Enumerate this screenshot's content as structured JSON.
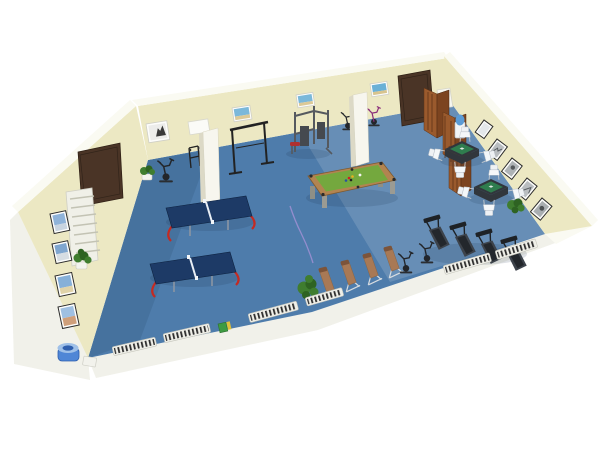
{
  "scene": {
    "type": "3d-room-render",
    "room": "recreation-and-fitness-room",
    "objects": [
      {
        "name": "ping-pong-table",
        "count": 2,
        "color": "#1d3a66"
      },
      {
        "name": "pool-table",
        "count": 1,
        "color": "#74a83e"
      },
      {
        "name": "mahjong-table",
        "count": 2,
        "color": "#2f7d4e"
      },
      {
        "name": "chair",
        "count": 8,
        "color": "#eef1f4"
      },
      {
        "name": "treadmill",
        "count": 4,
        "color": "#3d434b"
      },
      {
        "name": "incline-bench",
        "count": 4,
        "color": "#a87955"
      },
      {
        "name": "exercise-bike",
        "count": 5,
        "color": "#23262a"
      },
      {
        "name": "multi-gym-machine",
        "count": 1,
        "color": "#55595f"
      },
      {
        "name": "pull-up-frame",
        "count": 1,
        "color": "#222222"
      },
      {
        "name": "weight-rack",
        "count": 1,
        "color": "#222222"
      },
      {
        "name": "folding-screen",
        "count": 1,
        "color": "#9a5a2d"
      },
      {
        "name": "water-cooler",
        "count": 1,
        "color": "#5b9bd5"
      },
      {
        "name": "drinking-fountain",
        "count": 1,
        "color": "#4f86d6"
      },
      {
        "name": "radiator",
        "count": 7,
        "color": "#efefe8"
      },
      {
        "name": "door",
        "count": 2,
        "color": "#4a3426"
      },
      {
        "name": "column",
        "count": 2,
        "color": "#f7f6ee"
      },
      {
        "name": "plant",
        "count": 4,
        "color": "#3f7d2f"
      },
      {
        "name": "wall-picture",
        "count": 13,
        "color": "#7bb8da"
      },
      {
        "name": "floor-cable",
        "count": 1,
        "color": "#9b8fd2"
      },
      {
        "name": "utility-box",
        "count": 1,
        "color": "#3e9b42"
      }
    ]
  },
  "palette": {
    "background": "#ffffff",
    "wall": "#ece8c3",
    "wall_shade": "#ddd9b2",
    "wall_cap": "#fafaf2",
    "apron": "#f1f1ea",
    "floor": "#4e7cab",
    "door_brown": "#4a3426",
    "column_white": "#f7f6ee",
    "pingpong_top": "#1d3a66",
    "pingpong_leg_red": "#c42a22",
    "pool_felt": "#74a83e",
    "pool_rail": "#b28450",
    "mahjong_felt": "#2f7d4e",
    "mahjong_base": "#31363c",
    "chair_white": "#eef1f4",
    "treadmill_dark": "#3d434b",
    "bench_tan": "#a87955",
    "radiator_frame": "#efefe8",
    "radiator_slat": "#2e2e2e",
    "plant_green": "#3f7d2f",
    "water_blue": "#5b9bd5",
    "cable_purple": "#9b8fd2",
    "screen_wood_light": "#9a5a2d",
    "screen_wood_dark": "#7c4420"
  }
}
